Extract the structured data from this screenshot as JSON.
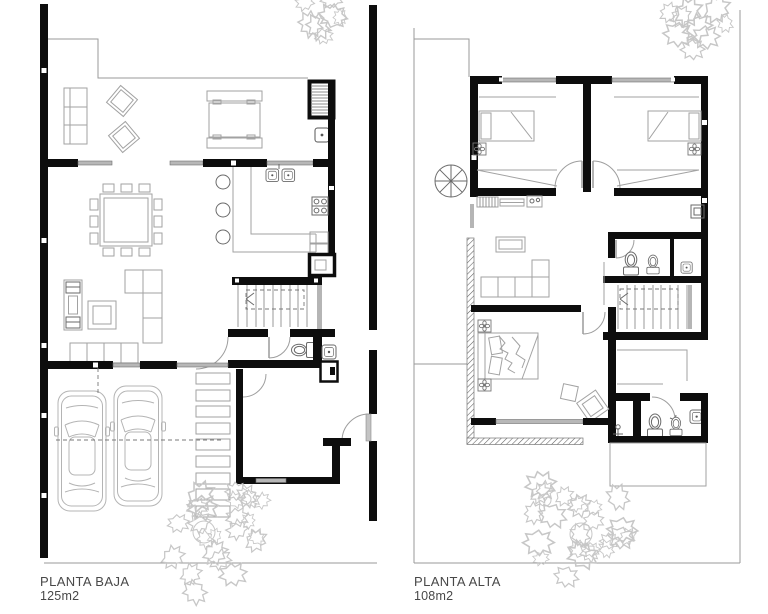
{
  "sheet": {
    "background": "#ffffff"
  },
  "colors": {
    "wall": "#0d0d0d",
    "furniture_line": "#a2a2a2",
    "fixture_line": "#6a6a6a",
    "window_fill": "#b7b7b7",
    "vegetation": "#c7c7c7",
    "label_text": "#484848"
  },
  "plans": [
    {
      "id": "planta-baja",
      "label": "PLANTA BAJA",
      "area": "125m2",
      "depicts": [
        "terrace-sofa",
        "patio-lounge-chairs",
        "patio-table-with-benches",
        "roof-hatch-grille",
        "water-heater",
        "dining-table-12-chairs",
        "kitchen-l-counter",
        "double-sink",
        "stove-4-burners",
        "refrigerator-niche",
        "bar-stools",
        "tv-shelf-unit",
        "corner-sofa",
        "armchair",
        "three-seat-sofa",
        "straight-stair-up",
        "wc-toilet",
        "washbasin",
        "boiler-closet",
        "two-cars",
        "paving-slab-path",
        "entry-gate-door",
        "vestibule",
        "shrubs",
        "tree"
      ]
    },
    {
      "id": "planta-alta",
      "label": "PLANTA ALTA",
      "area": "108m2",
      "depicts": [
        "bedroom-single-bed-1",
        "bedroom-single-bed-2",
        "wardrobe-closets",
        "ceiling-fan-symbols",
        "desk-shelf",
        "bathroom-wc-and-bidet",
        "washbasin",
        "straight-stair-down",
        "lounge-sofa",
        "coffee-table",
        "master-double-bed",
        "nightstands",
        "armchair",
        "pouf",
        "master-bathroom-wc-bidet",
        "shower",
        "balcony-parapet-hatched",
        "tree-circle-symbol",
        "shrubs",
        "tree"
      ]
    }
  ]
}
